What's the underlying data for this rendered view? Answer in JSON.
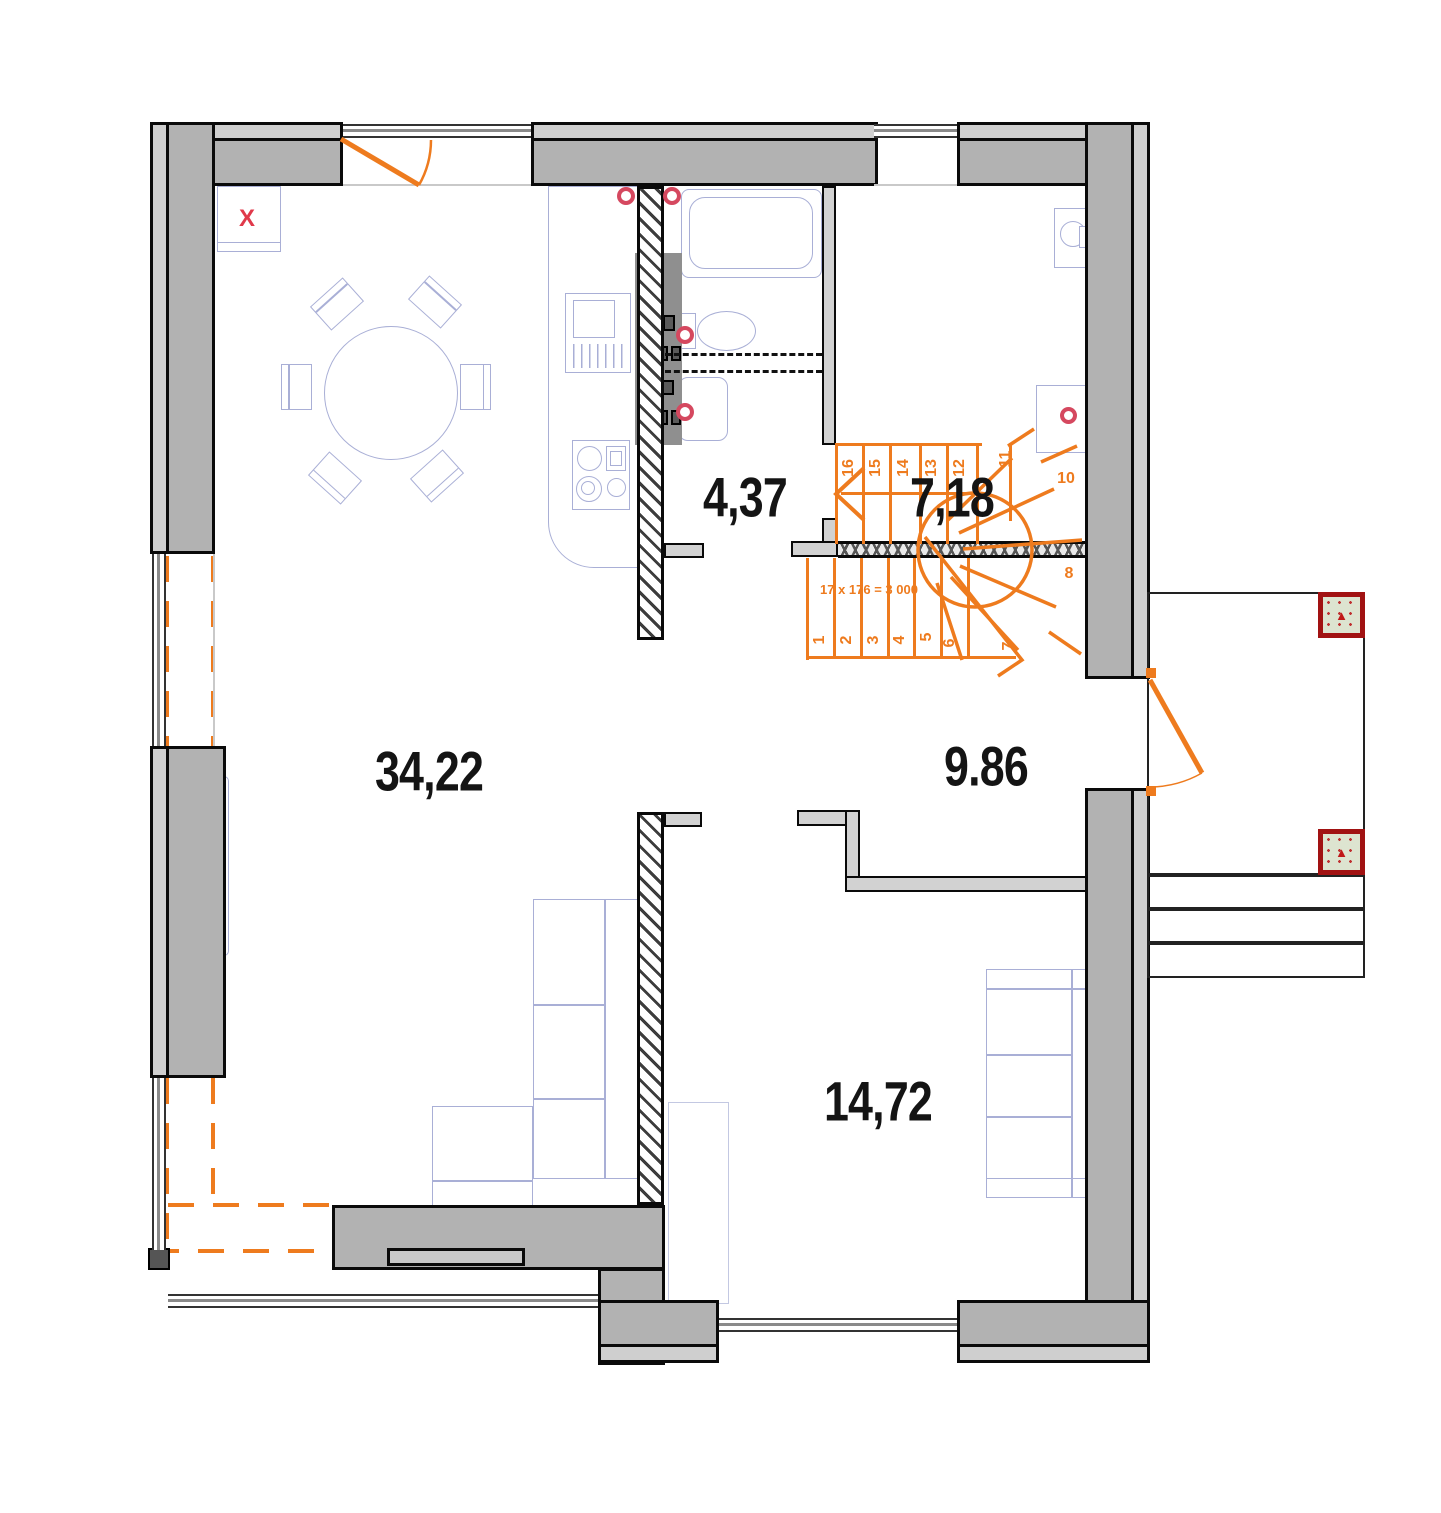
{
  "plan": {
    "rooms": {
      "living": {
        "area": "34,22"
      },
      "wc": {
        "area": "4,37"
      },
      "stair_hall": {
        "area": "7,18"
      },
      "hall": {
        "area": "9.86"
      },
      "bedroom": {
        "area": "14,72"
      }
    },
    "stairs": {
      "formula": "17 x 176 = 3 000",
      "upper_steps": [
        "16",
        "15",
        "14",
        "13",
        "12",
        "11",
        "10"
      ],
      "lower_steps": [
        "1",
        "2",
        "3",
        "4",
        "5",
        "6",
        "7",
        "8"
      ]
    },
    "markers": {
      "fireplace": "X",
      "column": "▲"
    },
    "colors": {
      "wall_fill": "#b2b2b2",
      "wall_leaf": "#cfcfcf",
      "outline": "#0a0a0a",
      "stair_accent": "#ee7b1e",
      "plumbing_red": "#d5485f",
      "marker_red": "#e0394a",
      "furniture_line": "#a9afd6",
      "column_fill": "#dde4d0",
      "column_border": "#a11212"
    }
  }
}
